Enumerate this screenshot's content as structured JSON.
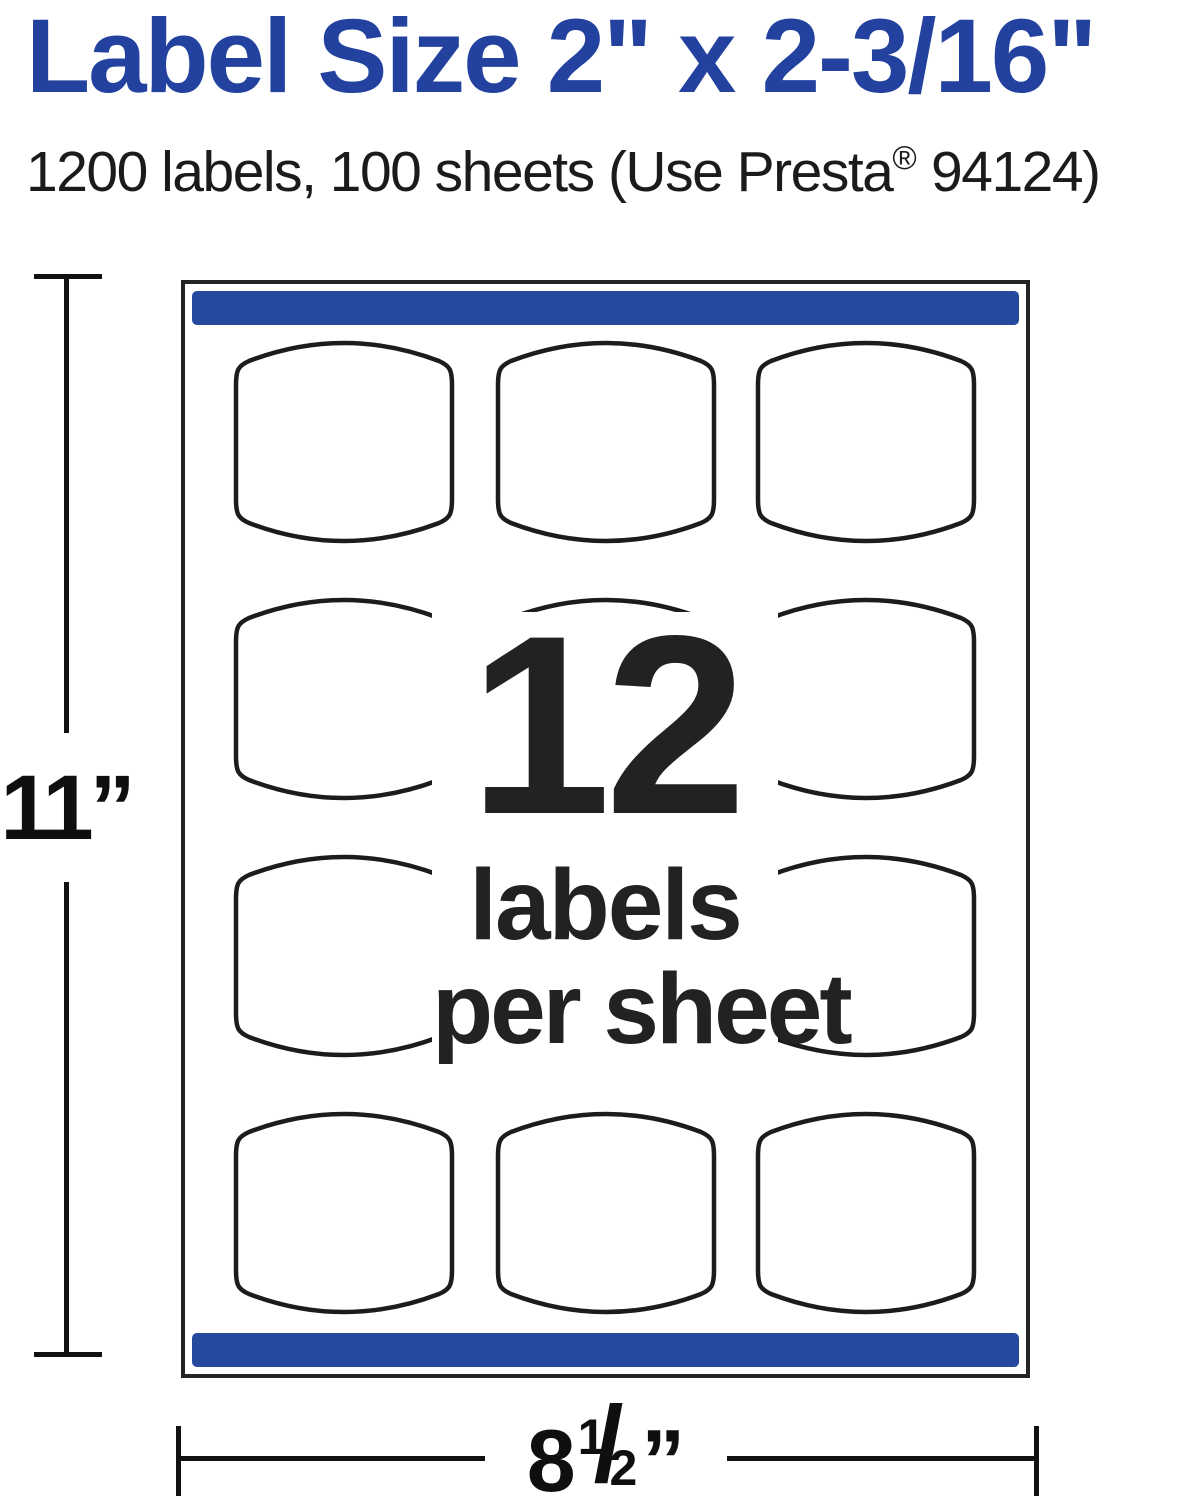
{
  "title": "Label Size 2\" x 2-3/16\"",
  "subtitle": {
    "pre": "1200 labels, 100 sheets (Use Presta",
    "reg": "®",
    "post": " 94124)"
  },
  "sheet": {
    "grid": {
      "rows": 4,
      "cols": 3
    },
    "callout": {
      "count": "12",
      "line1": "labels",
      "line2": "per sheet"
    }
  },
  "dimensions": {
    "height_value": "11”",
    "width_whole": "8",
    "width_numerator": "1",
    "width_slash": "/",
    "width_denominator": "2",
    "width_unit": "”"
  },
  "colors": {
    "title-blue": "#23429f",
    "bar-blue": "#254a9d",
    "ink": "#1c1c1c"
  }
}
